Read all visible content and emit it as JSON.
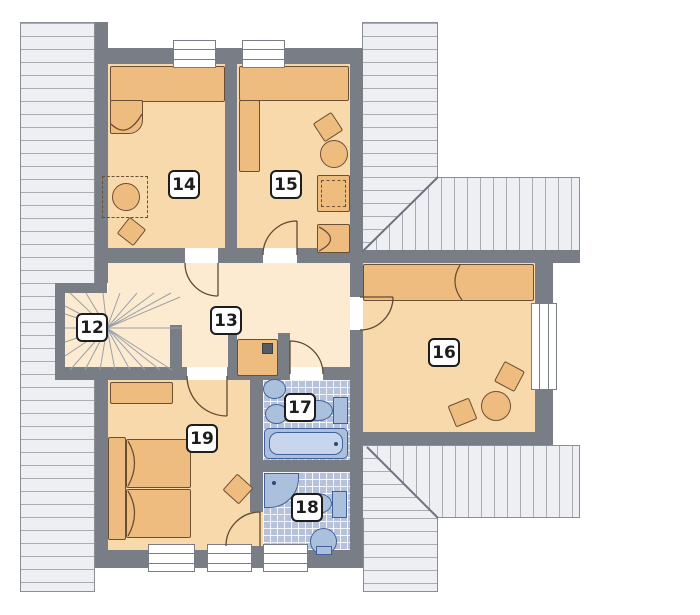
{
  "plan": {
    "kind": "floor-plan-upper-storey",
    "rooms": [
      {
        "label": "12",
        "type": "staircase"
      },
      {
        "label": "13",
        "type": "hallway"
      },
      {
        "label": "14",
        "type": "bedroom"
      },
      {
        "label": "15",
        "type": "bedroom"
      },
      {
        "label": "16",
        "type": "bedroom"
      },
      {
        "label": "17",
        "type": "bathroom"
      },
      {
        "label": "18",
        "type": "bathroom"
      },
      {
        "label": "19",
        "type": "bedroom"
      }
    ],
    "fixtures": {
      "bathroom_17": [
        "washbasin",
        "washbasin",
        "toilet",
        "bathtub"
      ],
      "bathroom_18": [
        "corner-shower",
        "toilet",
        "washbasin"
      ],
      "bedroom_14": [
        "bed",
        "round-table",
        "chair"
      ],
      "bedroom_15": [
        "bed",
        "wardrobe",
        "desk",
        "round-table",
        "chair"
      ],
      "bedroom_16": [
        "bed",
        "round-table",
        "chair",
        "chair"
      ],
      "bedroom_19": [
        "double-bed",
        "dresser",
        "chair",
        "closet"
      ]
    },
    "colors": {
      "wall": "#797d86",
      "room_floor": "#f8d9ab",
      "hall_floor": "#fcebd1",
      "furniture": "#efbc80",
      "furniture_outline": "#6b4f35",
      "fixture_blue": "#abc0dd",
      "tile_blue": "#b6c2da",
      "roof_hatch": "#edeff3",
      "label_border": "#1d1d1d"
    }
  }
}
